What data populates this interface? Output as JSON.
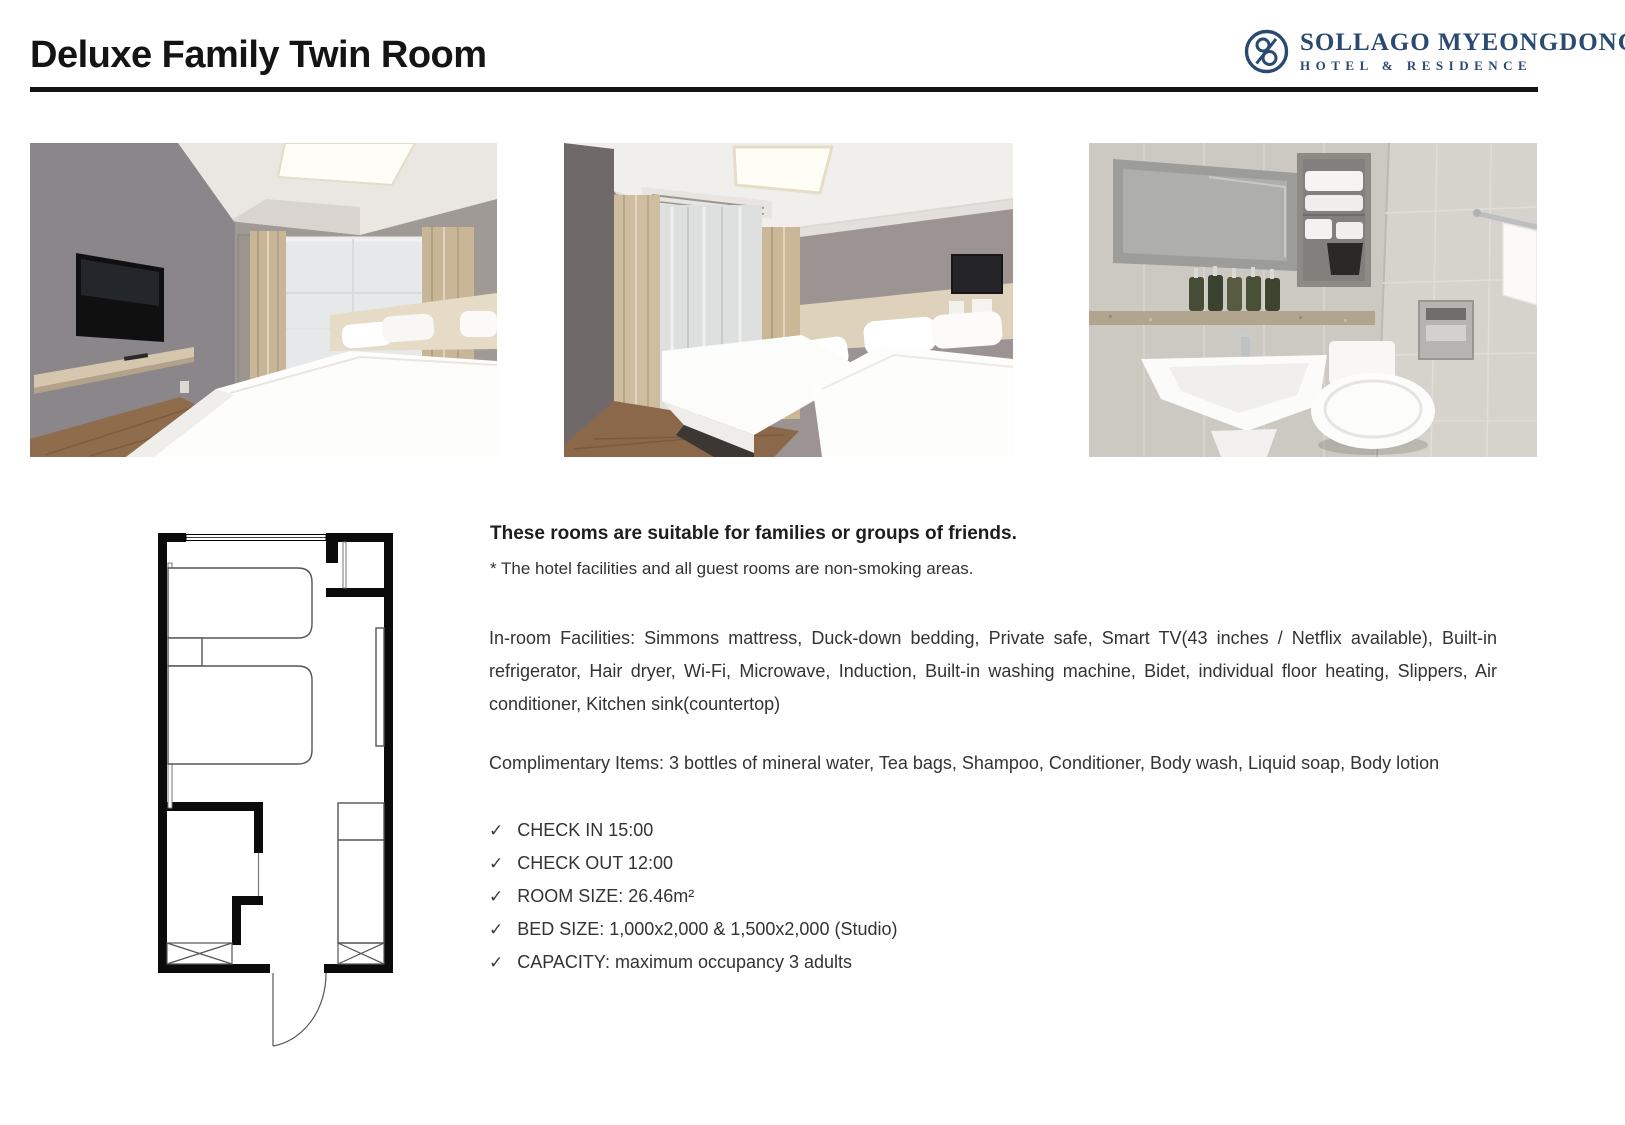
{
  "header": {
    "title": "Deluxe Family Twin Room",
    "logo": {
      "name": "SOLLAGO MYEONGDONG",
      "subtitle": "HOTEL  &  RESIDENCE",
      "color": "#2b4a72"
    }
  },
  "photos": [
    {
      "name": "bedroom-with-tv"
    },
    {
      "name": "bedroom-twin-and-double-beds"
    },
    {
      "name": "bathroom"
    }
  ],
  "floor_plan": {
    "name": "room-floor-plan"
  },
  "details": {
    "headline": "These rooms are suitable for families or groups of friends.",
    "note": "* The hotel facilities and all guest rooms are non-smoking areas.",
    "facilities": "In-room Facilities: Simmons mattress, Duck-down bedding, Private safe, Smart TV(43 inches / Netflix available), Built-in refrigerator, Hair dryer, Wi-Fi, Microwave, Induction, Built-in washing machine, Bidet, individual floor heating, Slippers, Air conditioner, Kitchen sink(countertop)",
    "complimentary": "Complimentary Items: 3 bottles of mineral water, Tea bags, Shampoo, Conditioner, Body wash, Liquid soap, Body lotion",
    "check_glyph": "✓",
    "checklist": [
      {
        "label": "CHECK IN 15:00"
      },
      {
        "label": "CHECK OUT 12:00"
      },
      {
        "label": "ROOM SIZE: 26.46m²"
      },
      {
        "label": "BED SIZE: 1,000x2,000 & 1,500x2,000 (Studio)"
      },
      {
        "label": "CAPACITY: maximum occupancy 3 adults"
      }
    ]
  },
  "colors": {
    "accent_navy": "#2b4a72",
    "rule_black": "#141414",
    "text": "#333333"
  }
}
